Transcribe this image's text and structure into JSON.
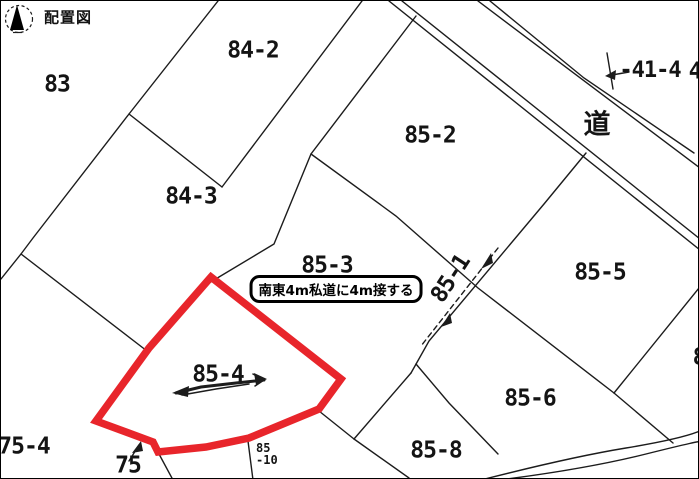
{
  "title": "配置図",
  "colors": {
    "red_outline": "#e8252b",
    "line": "#1c1c1c"
  },
  "road_label": "道",
  "annotation": {
    "text": "南東4m私道に4m接する"
  },
  "parcels": {
    "p83": "83",
    "p84_2": "84-2",
    "p84_3": "84-3",
    "p85_2": "85-2",
    "p85_3": "85-3",
    "p85_4": "85-4",
    "p85_5": "85-5",
    "p85_6": "85-6",
    "p85_8": "85-8",
    "p85_1": "85-1",
    "p75_4": "75-4",
    "p75": "75",
    "p85_10_line1": "85",
    "p85_10_line2": "-10",
    "p41_4": "-41-4",
    "p4_partial": "4",
    "p8_partial": "8"
  }
}
